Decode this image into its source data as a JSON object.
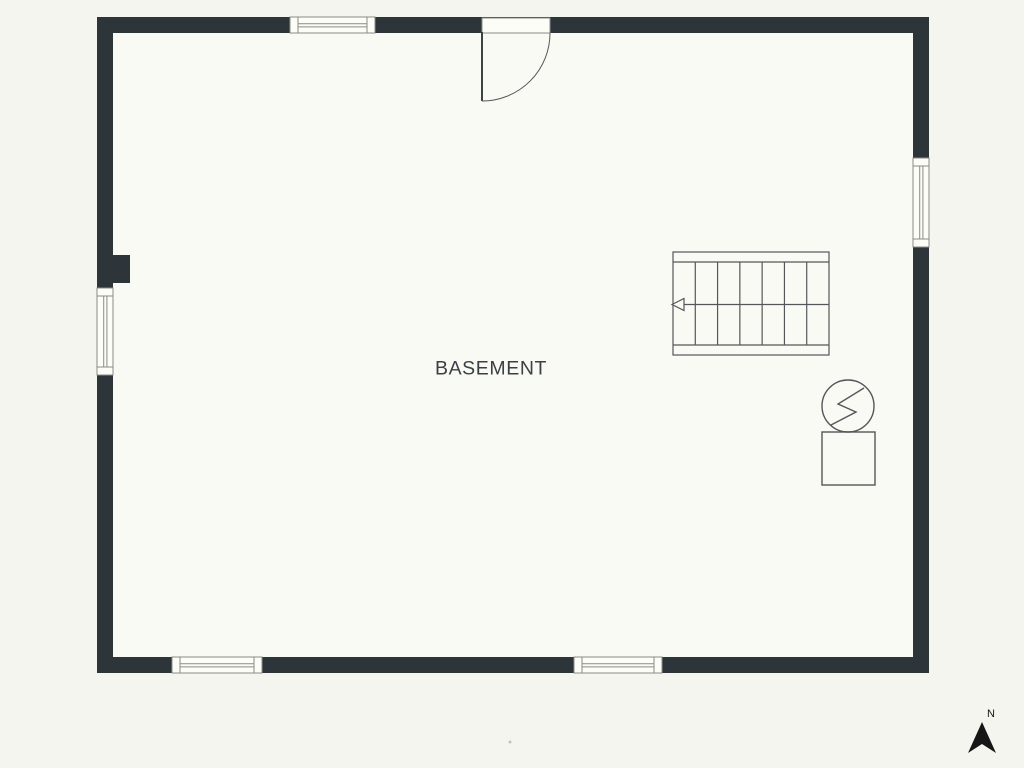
{
  "plan": {
    "room_label": "BASEMENT",
    "compass_label": "N",
    "colors": {
      "background": "#f5f5ef",
      "floor": "#fafaf5",
      "wall": "#2e353a",
      "line": "#54575a",
      "window_frame": "#8a8a86",
      "window_fill": "#fdfdf8",
      "text": "#3a4045",
      "compass": "#161616"
    },
    "canvas": {
      "width": 1024,
      "height": 768
    },
    "walls": {
      "x": 97,
      "y": 17,
      "width": 832,
      "height": 656,
      "thickness": 16
    },
    "pilaster": {
      "x": 97,
      "y": 255,
      "width": 33,
      "height": 28
    },
    "door": {
      "side": "top",
      "x": 482,
      "y": 17,
      "width": 68,
      "depth": 16,
      "hinge": "left",
      "swing": "inward-left"
    },
    "windows": [
      {
        "id": "window-top",
        "side": "top",
        "x": 290,
        "y": 17,
        "width": 85,
        "height": 16,
        "orientation": "horizontal"
      },
      {
        "id": "window-right",
        "side": "right",
        "x": 913,
        "y": 158,
        "width": 16,
        "height": 89,
        "orientation": "vertical"
      },
      {
        "id": "window-left",
        "side": "left",
        "x": 97,
        "y": 288,
        "width": 16,
        "height": 87,
        "orientation": "vertical"
      },
      {
        "id": "window-bottom-left",
        "side": "bottom",
        "x": 172,
        "y": 657,
        "width": 90,
        "height": 16,
        "orientation": "horizontal"
      },
      {
        "id": "window-bottom-center",
        "side": "bottom",
        "x": 574,
        "y": 657,
        "width": 88,
        "height": 16,
        "orientation": "horizontal"
      }
    ],
    "stairs": {
      "x": 673,
      "y": 252,
      "width": 156,
      "height": 103,
      "treads": 7,
      "band": 10,
      "arrow_direction": "left"
    },
    "utility": {
      "circle": {
        "cx": 848,
        "cy": 406,
        "r": 26,
        "symbol": "lightning-bolt"
      },
      "bolt_points": [
        [
          864,
          388
        ],
        [
          838,
          404
        ],
        [
          856,
          412
        ],
        [
          831,
          425
        ]
      ],
      "square": {
        "x": 822,
        "y": 432,
        "width": 53,
        "height": 53
      }
    },
    "compass": {
      "cx": 982,
      "arrow_top": 722,
      "arrow_height": 31,
      "arrow_halfwidth": 14,
      "notch_depth": 9
    },
    "watermark_dot": {
      "x": 510,
      "y": 742
    }
  }
}
